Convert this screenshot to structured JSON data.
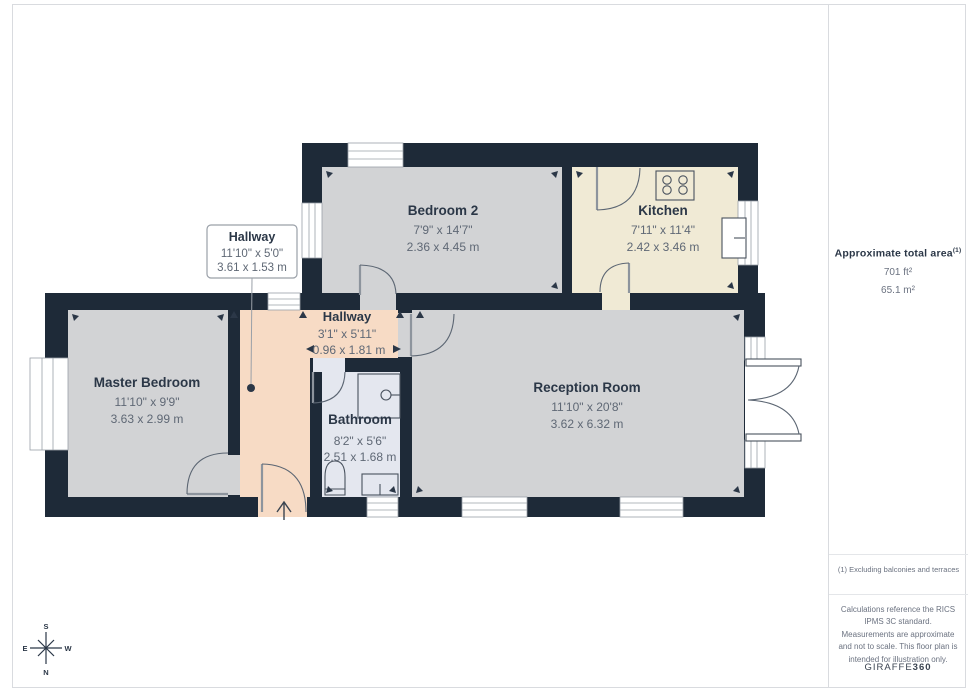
{
  "palette": {
    "wall": "#1e2a38",
    "gray": "#d2d3d5",
    "kitchen": "#f0ead5",
    "hall": "#f7dbc5",
    "bath": "#e4e7ef",
    "ink": "#2b3747",
    "dim": "#5f6875",
    "dim2": "#6b7280",
    "line": "#9aa0a8",
    "border": "#d9dbdf",
    "divider": "#e4e6e9"
  },
  "floorplan": {
    "rooms": [
      {
        "name": "Bedroom 2",
        "imperial": "7'9\" x 14'7\"",
        "metric": "2.36 x 4.45 m"
      },
      {
        "name": "Kitchen",
        "imperial": "7'11\" x 11'4\"",
        "metric": "2.42 x 3.46 m"
      },
      {
        "name": "Hallway",
        "imperial": "11'10\" x 5'0\"",
        "metric": "3.61 x 1.53 m"
      },
      {
        "name": "Hallway",
        "imperial": "3'1\" x 5'11\"",
        "metric": "0.96 x 1.81 m"
      },
      {
        "name": "Master Bedroom",
        "imperial": "11'10\" x 9'9\"",
        "metric": "3.63 x 2.99 m"
      },
      {
        "name": "Bathroom",
        "imperial": "8'2\" x 5'6\"",
        "metric": "2.51 x 1.68 m"
      },
      {
        "name": "Reception Room",
        "imperial": "11'10\" x 20'8\"",
        "metric": "3.62 x 6.32 m"
      }
    ],
    "compass": {
      "top": "S",
      "bottom": "N",
      "left": "E",
      "right": "W"
    }
  },
  "sidebar": {
    "area_title": "Approximate total area",
    "area_sup": "(1)",
    "area_ft": "701 ft²",
    "area_m": "65.1 m²",
    "footnote": "(1) Excluding balconies and terraces",
    "disclaimer": "Calculations reference the RICS IPMS 3C standard. Measurements are approximate and not to scale. This floor plan is intended for illustration only.",
    "brand_regular": "GIRAFFE",
    "brand_bold": "360"
  }
}
